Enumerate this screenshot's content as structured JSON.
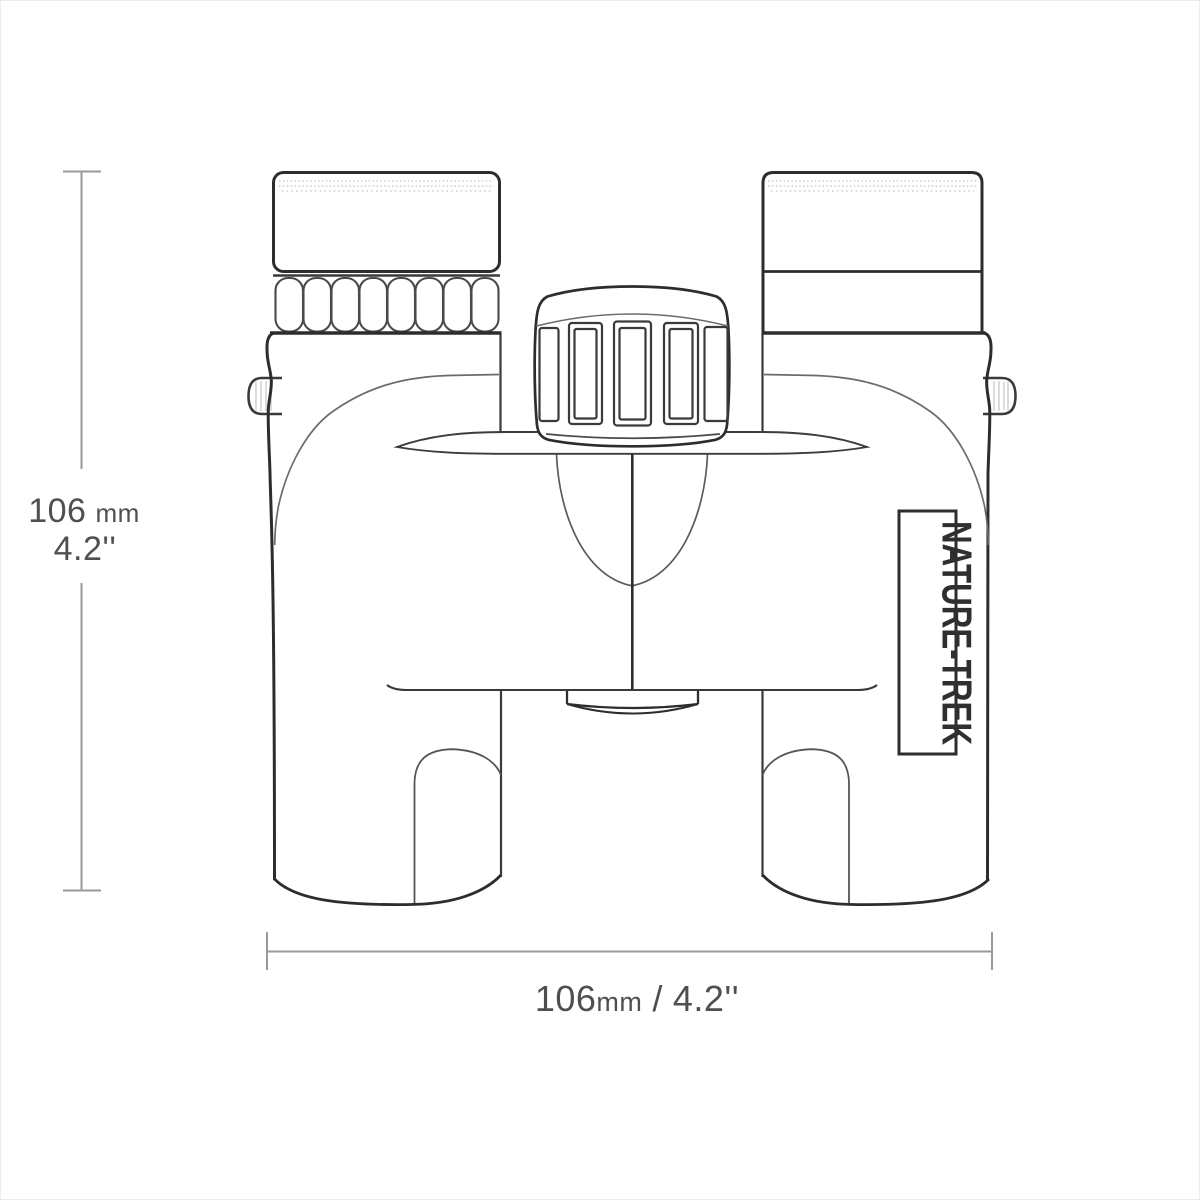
{
  "drawing": {
    "type": "technical outline drawing",
    "subject": "binoculars front view",
    "colors": {
      "outline": "#2d2d2d",
      "detail": "#4a4a4a",
      "seam": "#6b6b6b",
      "hatch": "#c4c4c4",
      "dimension_line": "#9a9a9a",
      "dimension_text": "#4f4f4f",
      "background": "#ffffff",
      "frame": "#ececec"
    }
  },
  "brand": {
    "label": "NATURE-TREK"
  },
  "dimensions": {
    "height": {
      "value": "106",
      "unit": "mm",
      "inches": "4.2''"
    },
    "width": {
      "value": "106",
      "unit": "mm",
      "separator": "/",
      "inches": "4.2''"
    }
  }
}
